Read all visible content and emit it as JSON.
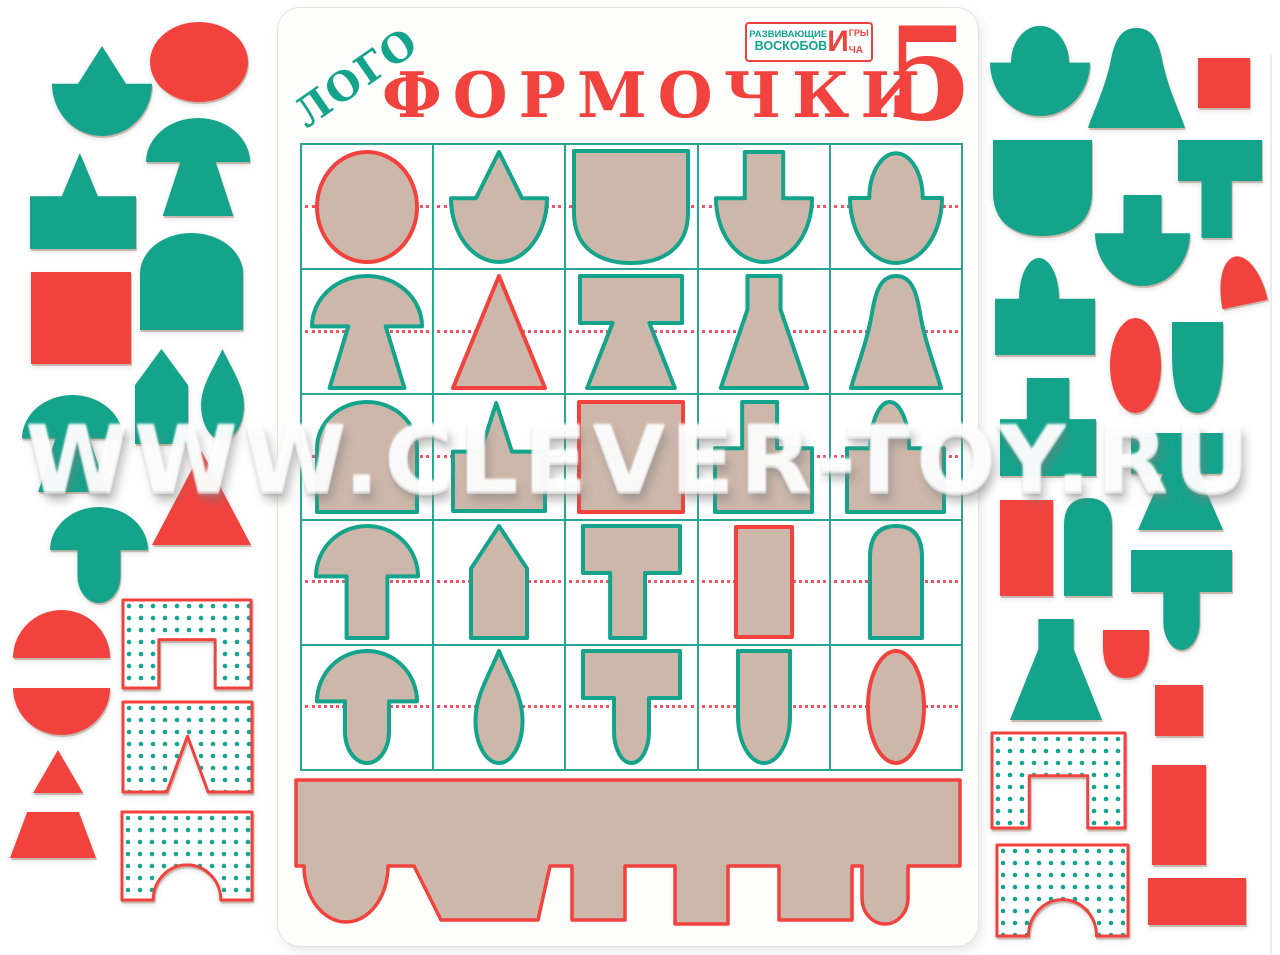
{
  "watermark": {
    "text": "WWW.CLEVER-TOY.RU"
  },
  "colors": {
    "teal": "#14a38b",
    "red": "#f2423e",
    "cardboard": "#cdb7aa",
    "grid_line": "#2ba593",
    "midline": "#ef5468",
    "dot": "#18a392",
    "white": "#ffffff"
  },
  "board": {
    "title_logo": "ЛОГО",
    "title_main": "ФОРМОЧКИ",
    "title_number": "5",
    "publisher": {
      "line1": "РАЗВИВАЮЩИЕ",
      "line2": "ВОСКОБОВ",
      "big_letter": "И",
      "word1_suffix": "ГРЫ",
      "word2_suffix": "ЧА"
    }
  },
  "grid": {
    "rows": 5,
    "cols": 5,
    "cells": [
      [
        {
          "shape": "circle",
          "outline": "red",
          "w": 100,
          "h": 110
        },
        {
          "shape": "cone_dome",
          "outline": "teal",
          "w": 96,
          "h": 110
        },
        {
          "shape": "shield_sq",
          "outline": "teal",
          "w": 114,
          "h": 112
        },
        {
          "shape": "rect_dome",
          "outline": "teal",
          "w": 96,
          "h": 110
        },
        {
          "shape": "acorn",
          "outline": "teal",
          "w": 92,
          "h": 112
        }
      ],
      [
        {
          "shape": "mushroom_trap",
          "outline": "teal",
          "w": 110,
          "h": 112
        },
        {
          "shape": "triangle",
          "outline": "red",
          "w": 92,
          "h": 112
        },
        {
          "shape": "spool",
          "outline": "teal",
          "w": 102,
          "h": 112
        },
        {
          "shape": "flask",
          "outline": "teal",
          "w": 92,
          "h": 112
        },
        {
          "shape": "bell",
          "outline": "teal",
          "w": 90,
          "h": 112
        }
      ],
      [
        {
          "shape": "arch",
          "outline": "teal",
          "w": 100,
          "h": 110
        },
        {
          "shape": "spike_rect",
          "outline": "teal",
          "w": 92,
          "h": 108
        },
        {
          "shape": "square",
          "outline": "red",
          "w": 104,
          "h": 110
        },
        {
          "shape": "t_inverted",
          "outline": "teal",
          "w": 97,
          "h": 110
        },
        {
          "shape": "dome_rect",
          "outline": "teal",
          "w": 97,
          "h": 110
        }
      ],
      [
        {
          "shape": "mushroom_rect",
          "outline": "teal",
          "w": 102,
          "h": 112
        },
        {
          "shape": "house",
          "outline": "teal",
          "w": 56,
          "h": 112
        },
        {
          "shape": "t_shape",
          "outline": "teal",
          "w": 97,
          "h": 112
        },
        {
          "shape": "vrect",
          "outline": "red",
          "w": 56,
          "h": 110
        },
        {
          "shape": "bullet",
          "outline": "teal",
          "w": 52,
          "h": 112
        }
      ],
      [
        {
          "shape": "mushroom_round",
          "outline": "teal",
          "w": 100,
          "h": 112
        },
        {
          "shape": "teardrop",
          "outline": "teal",
          "w": 56,
          "h": 112
        },
        {
          "shape": "t_round",
          "outline": "teal",
          "w": 97,
          "h": 112
        },
        {
          "shape": "u_rect",
          "outline": "teal",
          "w": 52,
          "h": 112
        },
        {
          "shape": "oval",
          "outline": "red",
          "w": 56,
          "h": 112
        }
      ]
    ]
  },
  "tray": {
    "outline": "red",
    "fill": "cardboard"
  },
  "pieces": [
    {
      "side": "left",
      "shape": "cone_dome",
      "color": "teal",
      "x": 52,
      "y": 46,
      "w": 100,
      "h": 90
    },
    {
      "side": "left",
      "shape": "circle",
      "color": "red",
      "x": 150,
      "y": 22,
      "w": 98,
      "h": 80
    },
    {
      "side": "left",
      "shape": "mushroom_trap",
      "color": "teal",
      "x": 146,
      "y": 118,
      "w": 104,
      "h": 98
    },
    {
      "side": "left",
      "shape": "spike_rect",
      "color": "teal",
      "x": 30,
      "y": 153,
      "w": 106,
      "h": 96
    },
    {
      "side": "left",
      "shape": "square",
      "color": "red",
      "x": 31,
      "y": 272,
      "w": 100,
      "h": 92
    },
    {
      "side": "left",
      "shape": "arch",
      "color": "teal",
      "x": 140,
      "y": 233,
      "w": 103,
      "h": 97
    },
    {
      "side": "left",
      "shape": "house",
      "color": "teal",
      "x": 135,
      "y": 349,
      "w": 53,
      "h": 95
    },
    {
      "side": "left",
      "shape": "teardrop",
      "color": "teal",
      "x": 197,
      "y": 349,
      "w": 51,
      "h": 91
    },
    {
      "side": "left",
      "shape": "mushroom_trap",
      "color": "teal",
      "x": 22,
      "y": 395,
      "w": 101,
      "h": 97
    },
    {
      "side": "left",
      "shape": "triangle",
      "color": "red",
      "x": 152,
      "y": 451,
      "w": 99,
      "h": 94
    },
    {
      "side": "left",
      "shape": "mushroom_round",
      "color": "teal",
      "x": 50,
      "y": 507,
      "w": 98,
      "h": 96
    },
    {
      "side": "left",
      "shape": "dome",
      "color": "red",
      "x": 13,
      "y": 610,
      "w": 97,
      "h": 48
    },
    {
      "side": "left",
      "shape": "bridge_sq",
      "color": "dotted",
      "x": 123,
      "y": 600,
      "w": 128,
      "h": 88
    },
    {
      "side": "left",
      "shape": "bowl",
      "color": "red",
      "x": 13,
      "y": 688,
      "w": 97,
      "h": 47
    },
    {
      "side": "left",
      "shape": "bridge_v",
      "color": "dotted",
      "x": 123,
      "y": 702,
      "w": 129,
      "h": 90
    },
    {
      "side": "left",
      "shape": "triangle",
      "color": "red",
      "x": 33,
      "y": 750,
      "w": 50,
      "h": 43
    },
    {
      "side": "left",
      "shape": "trapezoid",
      "color": "red",
      "x": 10,
      "y": 812,
      "w": 86,
      "h": 46
    },
    {
      "side": "left",
      "shape": "bridge_arch",
      "color": "dotted",
      "x": 122,
      "y": 812,
      "w": 130,
      "h": 88
    },
    {
      "side": "right",
      "shape": "acorn",
      "color": "teal",
      "x": 990,
      "y": 24,
      "w": 100,
      "h": 92
    },
    {
      "side": "right",
      "shape": "bell",
      "color": "teal",
      "x": 1088,
      "y": 28,
      "w": 97,
      "h": 100
    },
    {
      "side": "right",
      "shape": "square",
      "color": "red",
      "x": 1198,
      "y": 58,
      "w": 52,
      "h": 50
    },
    {
      "side": "right",
      "shape": "shield_sq",
      "color": "teal",
      "x": 993,
      "y": 140,
      "w": 99,
      "h": 96
    },
    {
      "side": "right",
      "shape": "t_shape",
      "color": "teal",
      "x": 1178,
      "y": 140,
      "w": 84,
      "h": 98
    },
    {
      "side": "right",
      "shape": "rect_dome",
      "color": "teal",
      "x": 1095,
      "y": 195,
      "w": 95,
      "h": 91
    },
    {
      "side": "right",
      "shape": "dome",
      "color": "red",
      "x": 1217,
      "y": 256,
      "w": 46,
      "h": 49,
      "rot": -12
    },
    {
      "side": "right",
      "shape": "dome_rect",
      "color": "teal",
      "x": 995,
      "y": 258,
      "w": 100,
      "h": 97
    },
    {
      "side": "right",
      "shape": "oval",
      "color": "red",
      "x": 1110,
      "y": 318,
      "w": 51,
      "h": 95
    },
    {
      "side": "right",
      "shape": "tooth",
      "color": "teal",
      "x": 1172,
      "y": 322,
      "w": 51,
      "h": 91
    },
    {
      "side": "right",
      "shape": "tower2",
      "color": "teal",
      "x": 1000,
      "y": 378,
      "w": 96,
      "h": 98
    },
    {
      "side": "right",
      "shape": "spool",
      "color": "teal",
      "x": 1131,
      "y": 433,
      "w": 99,
      "h": 97
    },
    {
      "side": "right",
      "shape": "vrect",
      "color": "red",
      "x": 1000,
      "y": 500,
      "w": 53,
      "h": 96
    },
    {
      "side": "right",
      "shape": "bullet",
      "color": "teal",
      "x": 1064,
      "y": 498,
      "w": 48,
      "h": 98
    },
    {
      "side": "right",
      "shape": "t_round",
      "color": "teal",
      "x": 1131,
      "y": 550,
      "w": 101,
      "h": 100
    },
    {
      "side": "right",
      "shape": "flask",
      "color": "teal",
      "x": 1007,
      "y": 619,
      "w": 98,
      "h": 101
    },
    {
      "side": "right",
      "shape": "tooth",
      "color": "red",
      "x": 1103,
      "y": 630,
      "w": 46,
      "h": 48
    },
    {
      "side": "right",
      "shape": "square",
      "color": "red",
      "x": 1155,
      "y": 685,
      "w": 48,
      "h": 51
    },
    {
      "side": "right",
      "shape": "bridge_sq",
      "color": "dotted",
      "x": 992,
      "y": 733,
      "w": 133,
      "h": 95
    },
    {
      "side": "right",
      "shape": "vrect",
      "color": "red",
      "x": 1152,
      "y": 765,
      "w": 54,
      "h": 100
    },
    {
      "side": "right",
      "shape": "bridge_arch",
      "color": "dotted",
      "x": 997,
      "y": 845,
      "w": 131,
      "h": 91
    },
    {
      "side": "right",
      "shape": "hrect",
      "color": "red",
      "x": 1148,
      "y": 878,
      "w": 98,
      "h": 47
    }
  ]
}
